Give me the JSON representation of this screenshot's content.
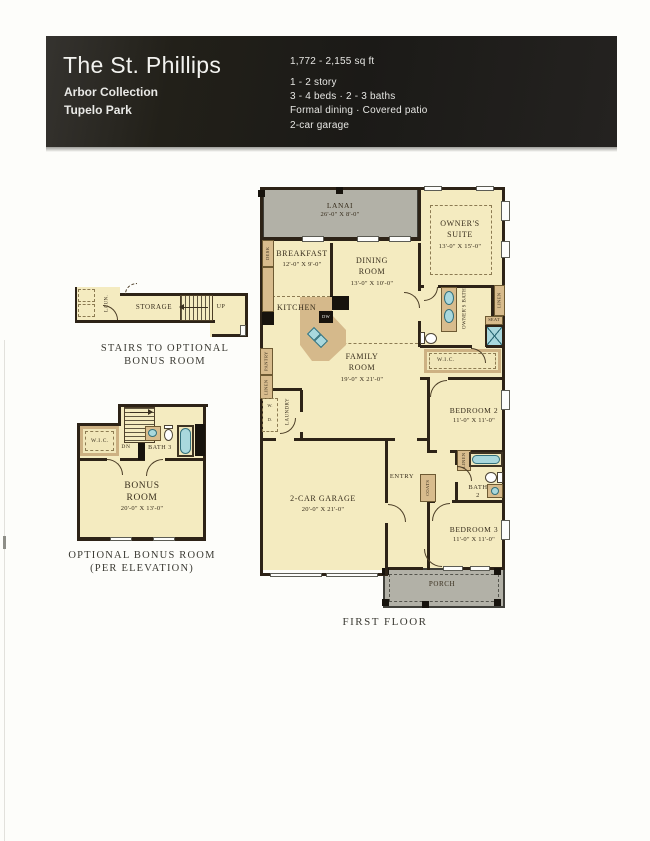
{
  "header": {
    "title": "The St. Phillips",
    "collection": "Arbor Collection",
    "community": "Tupelo Park",
    "sqft": "1,772 - 2,155 sq ft",
    "story": "1 - 2 story",
    "beds_baths": "3 - 4 beds · 2 - 3 baths",
    "features": "Formal dining · Covered patio",
    "garage": "2-car garage"
  },
  "stairs_plan": {
    "caption1": "STAIRS TO OPTIONAL",
    "caption2": "BONUS ROOM",
    "storage": "STORAGE",
    "up": "UP",
    "laun": "LAUN."
  },
  "bonus_plan": {
    "caption1": "OPTIONAL BONUS ROOM",
    "caption2": "(PER ELEVATION)",
    "name1": "BONUS",
    "name2": "ROOM",
    "dims": "20'-0\" X 13'-0\"",
    "wic": "W.I.C.",
    "dn": "DN",
    "bath3": "BATH 3"
  },
  "first_floor": {
    "caption": "FIRST FLOOR",
    "lanai": "LANAI",
    "lanai_dims": "26'-0\" X 8'-0\"",
    "owners_suite1": "OWNER'S",
    "owners_suite2": "SUITE",
    "owners_suite_dims": "13'-0\" X 15'-0\"",
    "breakfast": "BREAKFAST",
    "breakfast_dims": "12'-0\" X 9'-0\"",
    "dining1": "DINING",
    "dining2": "ROOM",
    "dining_dims": "13'-0\" X 10'-0\"",
    "kitchen": "KITCHEN",
    "family1": "FAMILY",
    "family2": "ROOM",
    "family_dims": "19'-0\" X 21'-0\"",
    "owners_bath": "OWNER'S BATH",
    "wic": "W.I.C.",
    "bedroom2": "BEDROOM 2",
    "bedroom2_dims": "11'-0\" X 11'-0\"",
    "garage": "2-CAR GARAGE",
    "garage_dims": "20'-0\" X 21'-0\"",
    "entry": "ENTRY",
    "coats": "COATS",
    "linen": "LINEN",
    "bath2a": "BATH",
    "bath2b": "2",
    "bedroom3": "BEDROOM 3",
    "bedroom3_dims": "11'-0\" X 11'-0\"",
    "porch": "PORCH",
    "desk": "DESK",
    "pantry": "PANTRY",
    "laundry": "LAUNDRY",
    "wd1": "W.",
    "wd2": "D.",
    "seat": "SEAT",
    "dw": "DW"
  }
}
